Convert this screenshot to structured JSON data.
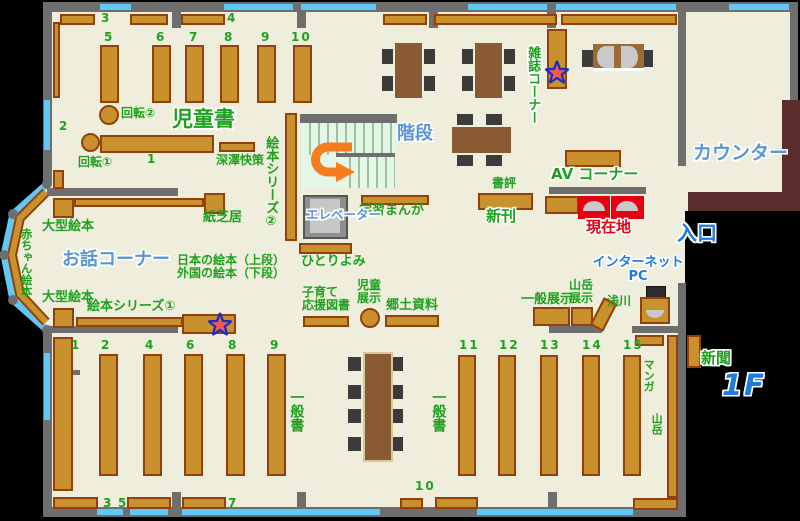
{
  "floor_label": "1F",
  "areas": {
    "children_books": "児童書",
    "story_corner": "お話コーナー",
    "magazine_corner": "雑誌コーナー",
    "stairs": "階段",
    "elevator": "エレベーター",
    "counter": "カウンター",
    "entrance": "入口",
    "av_corner": "AV コーナー",
    "internet_pc": "インターネット\nPC",
    "current_location": "現在地"
  },
  "labels": {
    "kaiten1": "回転①",
    "kaiten2": "回転②",
    "fukazawa": "深澤快策",
    "ehon_series2": "絵本シリーズ②",
    "kamishibai": "紙芝居",
    "ogata_ehon": "大型絵本",
    "akachan_ehon": "赤ちゃん絵本",
    "nihon_gaikoku": "日本の絵本（上段）\n外国の絵本（下段）",
    "hitoriyomi": "ひとりよみ",
    "gakushu_manga": "学習まんが",
    "ehon_series1": "絵本シリーズ①",
    "shohyo": "書評",
    "shinkan": "新刊",
    "kosodate": "子育て\n応援図書",
    "jido_tenji": "児童\n展示",
    "kyodo_shiryo": "郷土資料",
    "ippan_tenji": "一般展示",
    "sangaku_tenji": "山岳\n展示",
    "asakawa": "浅川",
    "ippansho": "一般書",
    "manga": "マンガ",
    "sangaku": "山岳",
    "shinbun": "新聞"
  },
  "shelf_numbers": {
    "top": [
      "3",
      "4",
      "5",
      "6",
      "7",
      "8",
      "9",
      "10",
      "2",
      "1"
    ],
    "bottom_left": [
      "1",
      "2",
      "4",
      "6",
      "8",
      "9",
      "3",
      "5",
      "7",
      "10"
    ],
    "bottom_right": [
      "11",
      "12",
      "13",
      "14",
      "15"
    ]
  },
  "colors": {
    "floor": "#efeedd",
    "wall": "#6e6e6e",
    "window": "#5fc8f5",
    "shelf": "#c9912d",
    "shelf_border": "#93400a",
    "green_text": "#1fa11f",
    "blue_text": "#5a95d5",
    "strong_blue_text": "#1d7ae1",
    "red": "#e60012",
    "counter_desk": "#5a2e2c",
    "arrow": "#f57d20"
  }
}
